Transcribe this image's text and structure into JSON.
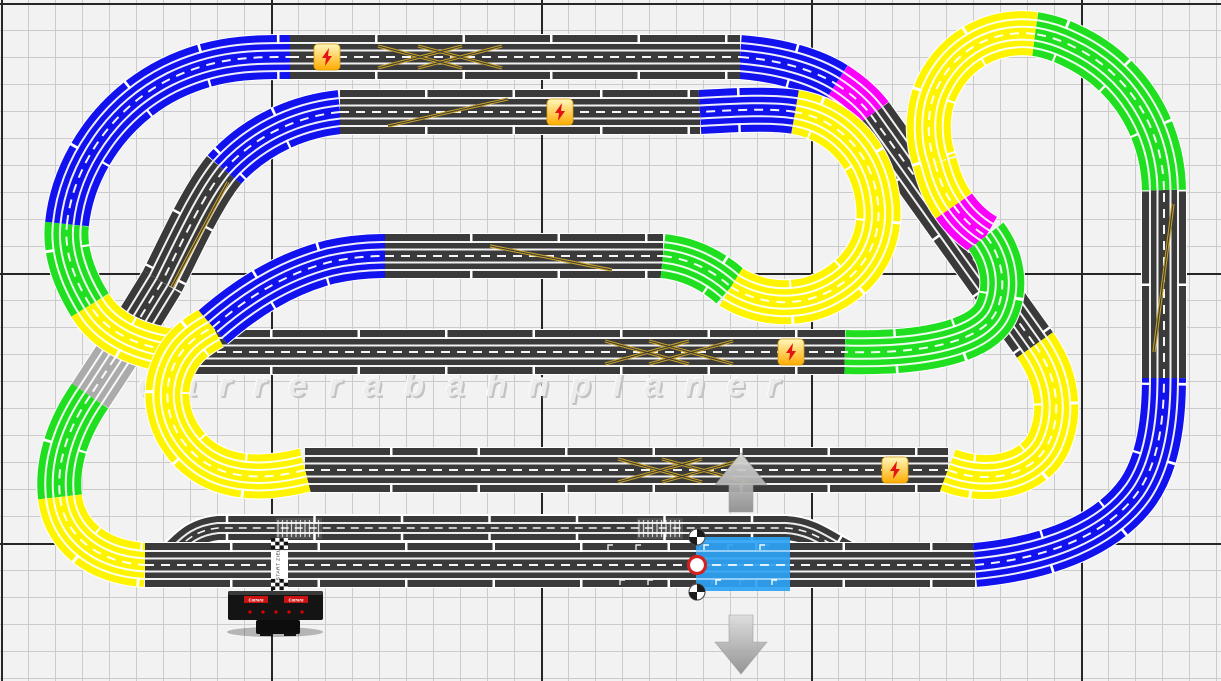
{
  "app": {
    "name": "slot-car-track-planner"
  },
  "canvas": {
    "width": 1221,
    "height": 681,
    "background": "#f2f2f2",
    "grid": {
      "minor_spacing": 27,
      "major_spacing": 270,
      "offset_x": 2,
      "offset_y": 4,
      "minor_color": "#cbcbcb",
      "major_color": "#262626"
    }
  },
  "watermark": {
    "text": "carrerabahnplaner"
  },
  "palette": {
    "blue": "#1212ee",
    "green": "#20df20",
    "yellow": "#fff400",
    "magenta": "#fb00fb",
    "dark": "#3a3a3a",
    "silver": "#ababab",
    "rail": "#ffffff"
  },
  "chains": [
    {
      "name": "top-right-blue-exit",
      "segments": [
        {
          "color": "blue",
          "d": "M740 57 C778 60 812 69 836 84",
          "plen": 52
        },
        {
          "color": "magenta",
          "d": "M836 84 C850 93 862 103 871 115",
          "plen": 48
        },
        {
          "color": "dark",
          "d": "M871 115 L1035 345",
          "plen": 67
        }
      ]
    },
    {
      "name": "left-descender",
      "segments": [
        {
          "color": "blue",
          "d": "M340 112 C292 117 252 139 224 170",
          "plen": 60
        },
        {
          "color": "dark",
          "d": "M224 170 C203 196 184 238 162 282",
          "plen": 58
        },
        {
          "color": "dark",
          "d": "M162 282 L124 344",
          "plen": 70
        },
        {
          "color": "silver",
          "d": "M124 344 L90 396",
          "plen": 70
        },
        {
          "color": "green",
          "d": "M90 396 C68 428 56 463 60 497",
          "plen": 55
        },
        {
          "color": "yellow",
          "d": "M60 497 C64 534 95 562 145 565",
          "plen": 55
        }
      ]
    },
    {
      "name": "top-straight",
      "segments": [
        {
          "color": "dark",
          "d": "M290 57 L740 57",
          "plen": 85
        }
      ]
    },
    {
      "name": "straight-b",
      "segments": [
        {
          "color": "dark",
          "d": "M340 112 L700 112",
          "plen": 85
        }
      ]
    },
    {
      "name": "straight-c",
      "segments": [
        {
          "color": "dark",
          "d": "M385 256 L663 256",
          "plen": 85
        }
      ]
    },
    {
      "name": "straight-d",
      "segments": [
        {
          "color": "dark",
          "d": "M185 352 L845 352",
          "plen": 85
        }
      ]
    },
    {
      "name": "straight-e",
      "segments": [
        {
          "color": "dark",
          "d": "M305 470 L948 470",
          "plen": 85
        }
      ]
    },
    {
      "name": "bottom-straight",
      "segments": [
        {
          "color": "dark",
          "d": "M145 565 L975 565",
          "plen": 85
        }
      ]
    },
    {
      "name": "outer-left-curve",
      "segments": [
        {
          "color": "yellow",
          "d": "M185 352 C138 349 105 331 90 305",
          "plen": 60
        },
        {
          "color": "green",
          "d": "M90 305 C72 276 64 248 67 224",
          "plen": 60
        },
        {
          "color": "blue",
          "d": "M67 224 C73 166 112 108 170 79 C215 57 252 57 290 57",
          "plen": 72
        }
      ]
    },
    {
      "name": "left-inner-horseshoe",
      "segments": [
        {
          "color": "yellow",
          "d": "M305 470 C258 482 218 478 192 452 C168 428 162 396 172 370 C180 348 196 336 213 327",
          "plen": 60
        }
      ]
    },
    {
      "name": "horseshoe-to-c",
      "segments": [
        {
          "color": "blue",
          "d": "M213 327 C242 302 280 275 330 262 C348 258 366 256 385 256",
          "plen": 62
        }
      ]
    },
    {
      "name": "middle-ring",
      "segments": [
        {
          "color": "green",
          "d": "M663 256 C690 259 712 270 731 287",
          "plen": 55
        },
        {
          "color": "yellow",
          "d": "M731 287 C762 306 800 307 830 291 C867 271 884 235 877 196 C870 152 838 119 795 112",
          "plen": 62
        },
        {
          "color": "blue",
          "d": "M795 112 C772 108 735 110 700 112",
          "plen": 55
        }
      ]
    },
    {
      "name": "right-inner-hairpin",
      "segments": [
        {
          "color": "yellow",
          "d": "M1035 345 C1056 375 1063 410 1049 442 C1035 474 990 486 948 470",
          "plen": 62
        }
      ]
    },
    {
      "name": "bottom-right-curve",
      "segments": [
        {
          "color": "blue",
          "d": "M975 565 C1050 558 1108 534 1138 492 C1156 466 1164 428 1164 378",
          "plen": 72
        }
      ]
    },
    {
      "name": "right-vertical",
      "segments": [
        {
          "color": "dark",
          "d": "M1164 378 L1164 190",
          "plen": 92
        }
      ]
    },
    {
      "name": "top-right-loop-green",
      "segments": [
        {
          "color": "green",
          "d": "M1164 190 C1163 128 1128 72 1072 46 C1060 40 1048 36 1035 34",
          "plen": 62
        }
      ]
    },
    {
      "name": "top-right-loop-yellow",
      "segments": [
        {
          "color": "yellow",
          "d": "M1035 34 C986 28 947 57 933 98 C927 117 927 141 935 163",
          "plen": 62
        }
      ]
    },
    {
      "name": "loop-reversal",
      "segments": [
        {
          "color": "yellow",
          "d": "M935 163 C939 179 945 194 954 206",
          "plen": 48
        },
        {
          "color": "magenta",
          "d": "M954 206 C963 219 974 229 986 236",
          "plen": 44
        },
        {
          "color": "green",
          "d": "M986 236 C1002 257 1008 286 996 312 C980 345 912 354 845 352",
          "plen": 62
        }
      ]
    }
  ],
  "pit_lane": {
    "d": "M152 565 C178 559 180 532 218 528 L786 528 C824 530 838 558 880 563",
    "color": "dark",
    "plen": 85
  },
  "markings": {
    "color": "#c9a227",
    "inner": "#3a3a3a",
    "paths": [
      {
        "name": "row-a-double-cross",
        "d": "M378 46 L462 68 M378 68 L462 46 M418 46 L502 68 M418 68 L502 46"
      },
      {
        "name": "row-b-lane-change",
        "d": "M388 126 L508 99"
      },
      {
        "name": "row-c-lane-change",
        "d": "M490 246 L612 270"
      },
      {
        "name": "row-d-double-cross",
        "d": "M605 341 L689 364 M605 364 L689 341 M649 341 L733 364 M649 364 L733 341"
      },
      {
        "name": "row-e-double-cross",
        "d": "M618 459 L702 482 M618 482 L702 459 M662 459 L746 482 M662 482 L746 459"
      },
      {
        "name": "right-vertical-lane-change",
        "d": "M1173 204 L1154 352"
      },
      {
        "name": "left-curve-lane-change",
        "d": "M228 182 Q203 228 172 287"
      }
    ]
  },
  "boosters": {
    "icon": "lightning-icon",
    "fill_top": "#fff7be",
    "fill_bottom": "#ffab00",
    "border": "#d89e00",
    "bolt_color": "#e31313",
    "positions": [
      {
        "x": 327,
        "y": 57
      },
      {
        "x": 560,
        "y": 112
      },
      {
        "x": 791,
        "y": 352
      },
      {
        "x": 895,
        "y": 470
      }
    ]
  },
  "start_finish": {
    "label": "START ZIEL",
    "x": 271,
    "y": 551,
    "checker_color": "#111111"
  },
  "pit_boxes": [
    {
      "x": 276,
      "y": 518,
      "w": 46,
      "h": 21
    },
    {
      "x": 637,
      "y": 518,
      "w": 46,
      "h": 21
    }
  ],
  "lane_brackets": [
    [
      608,
      545
    ],
    [
      636,
      545
    ],
    [
      700,
      545
    ],
    [
      728,
      545
    ],
    [
      620,
      580
    ],
    [
      648,
      580
    ],
    [
      712,
      580
    ],
    [
      740,
      580
    ],
    [
      764,
      545
    ],
    [
      776,
      580
    ]
  ],
  "controller": {
    "brand_label": "Carrera",
    "body": {
      "x": 228,
      "y": 591,
      "w": 95,
      "h": 29
    },
    "led_color": "#e00000",
    "logo_color": "#cc1111"
  },
  "selection": {
    "x": 696,
    "y": 537,
    "w": 94,
    "h": 54,
    "color": "#2ea3f4",
    "anchor_color": "#d32222",
    "arrow_up": {
      "x": 741,
      "y": 453
    },
    "arrow_down": {
      "x": 741,
      "y": 674
    }
  }
}
